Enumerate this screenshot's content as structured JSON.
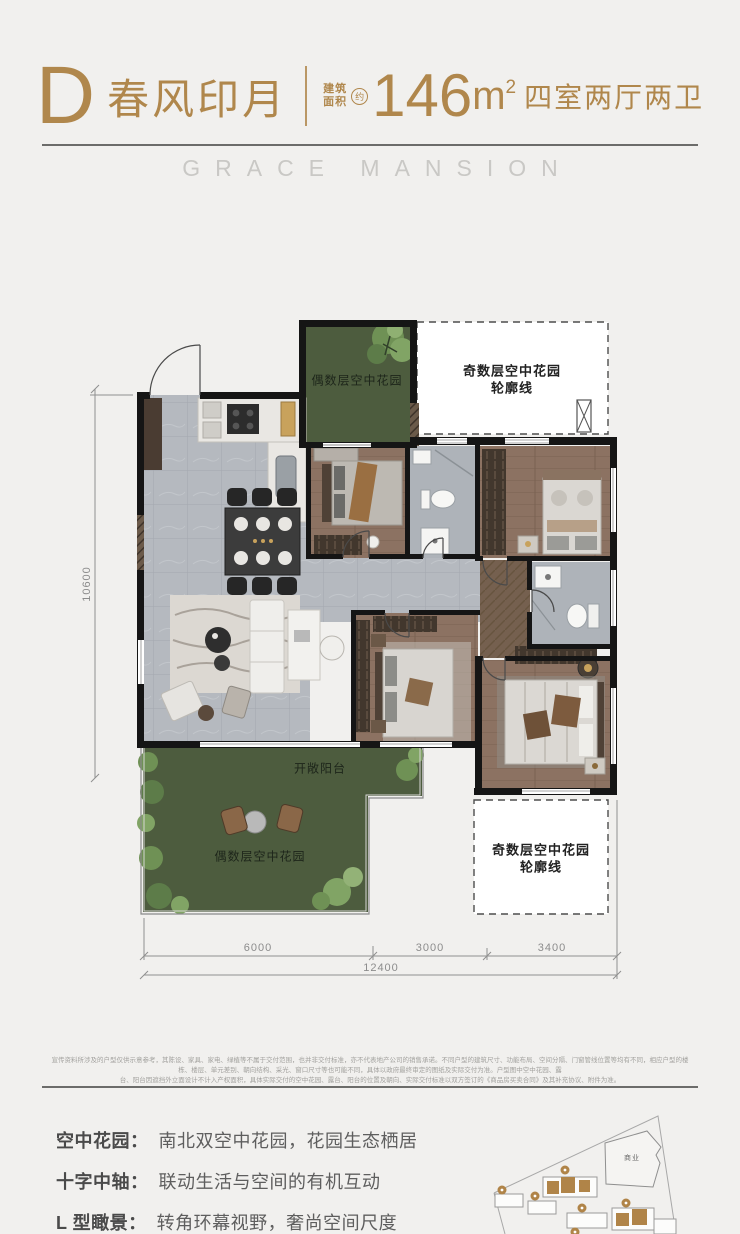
{
  "header": {
    "unit_letter": "D",
    "unit_name": "春风印月",
    "area_label_line1": "建筑",
    "area_label_line2": "面积",
    "area_approx": "约",
    "area_value": "146",
    "area_unit": "m",
    "area_exponent": "2",
    "layout_desc": "四室两厅两卫"
  },
  "brand": {
    "name": "GRACE MANSION"
  },
  "floor_plan": {
    "labels": {
      "garden_top": "偶数层空中花园",
      "outline_top_line1": "奇数层空中花园",
      "outline_top_line2": "轮廓线",
      "balcony": "开敞阳台",
      "garden_bottom": "偶数层空中花园",
      "outline_bottom_line1": "奇数层空中花园",
      "outline_bottom_line2": "轮廓线"
    },
    "dimensions": {
      "bottom_segments": [
        "6000",
        "3000",
        "3400"
      ],
      "bottom_total": "12400",
      "left_total": "10600"
    }
  },
  "disclaimer": {
    "line1": "宣传资料所涉及的户型仅供示意参考，其陈设、家具、家电、绿植等不属于交付范围，也并非交付标准，亦不代表地产公司的销售承诺。不同户型的建筑尺寸、功能布局、空间分隔、门窗管线位置等均有不同，相应户型的楼栋、楼层、单元差别、朝向结构、采光、窗口尺寸等也可能不同，具体以政府最终审定的图纸及实际交付为准。户型图中空中花园、露",
    "line2": "台、阳台因遮挡外立面设计不计入产权面积，具体实际交付的空中花园、露台、阳台的位置及朝向、实际交付标准以双方签订的《商品房买卖合同》及其补充协议、附件为准。"
  },
  "features": [
    {
      "label": "空中花园：",
      "desc": "南北双空中花园，花园生态栖居"
    },
    {
      "label": "十字中轴：",
      "desc": "联动生活与空间的有机互动"
    },
    {
      "label": "L 型瞰景：",
      "desc": "转角环幕视野，奢尚空间尺度"
    }
  ],
  "site_map": {
    "commercial_label": "商业"
  }
}
